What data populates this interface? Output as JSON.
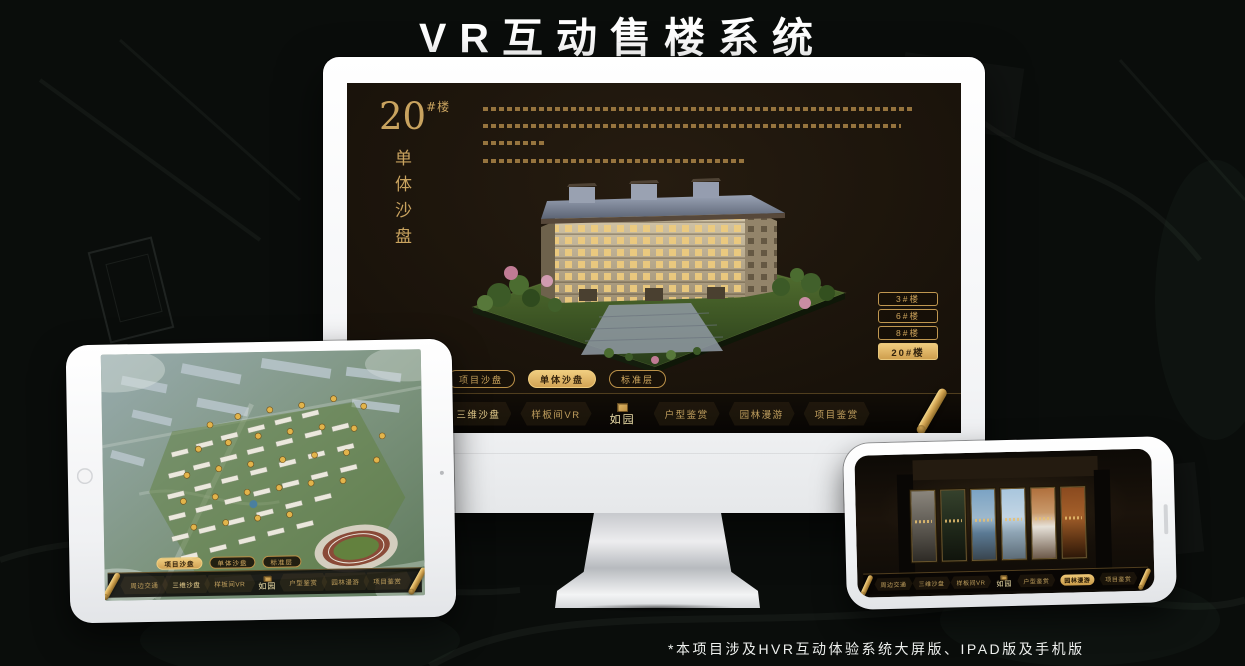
{
  "title": "VR互动售楼系统",
  "footnote": "*本项目涉及HVR互动体验系统大屏版、IPAD版及手机版",
  "block": {
    "no": "20",
    "unit": "#楼",
    "sub": "单体沙盘"
  },
  "buildings": [
    "3#楼",
    "6#楼",
    "8#楼",
    "20#楼"
  ],
  "tabs": [
    "项目沙盘",
    "单体沙盘",
    "标准层"
  ],
  "nav": [
    "周边交通",
    "三维沙盘",
    "样板间VR",
    "户型鉴赏",
    "园林漫游",
    "项目鉴赏"
  ],
  "logo": "如园",
  "colors": {
    "gold": "#d4aa5e",
    "gold_bright": "#eecb7d",
    "screen_bg": "#17110a",
    "canvas_bg": "#0a0d0b",
    "highlight_text": "#33220c"
  }
}
